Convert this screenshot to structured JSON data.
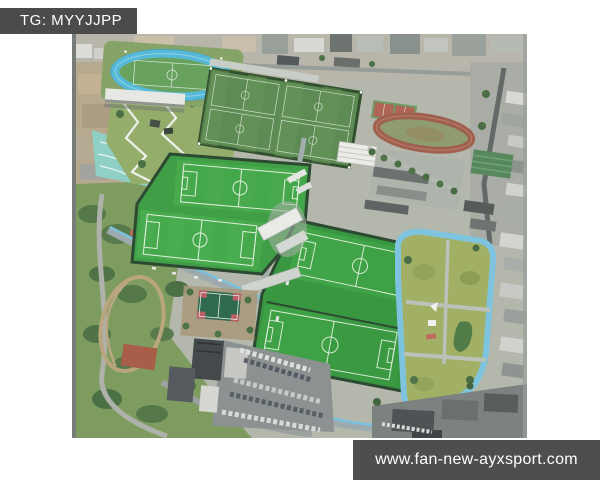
{
  "page": {
    "width": 600,
    "height": 480,
    "background": "#ffffff"
  },
  "watermarks": {
    "telegram": {
      "text": "TG: MYYJJPP",
      "background": "#4b4b4b",
      "color": "#ffffff"
    },
    "website": {
      "text": "www.fan-new-ayxsport.com",
      "background": "#4e4e4e",
      "color": "#ffffff"
    }
  },
  "photo": {
    "type": "aerial-drone-photograph",
    "alt": "Aerial view of a football training complex: a stadium with blue running track, natural grass training pitches, four artificial turf football fields, a school athletics track, a park ringed by a light-blue jogging loop, basketball court, parking lots, wooded hillside and surrounding city blocks",
    "regions": [
      "stadium-with-blue-track",
      "grandstand",
      "zigzag-park-paths",
      "teal-landscaped-slope",
      "natural-grass-training-field",
      "turf-pitch-a",
      "turf-pitch-b",
      "turf-pitch-c",
      "turf-pitch-d",
      "school-athletics-track",
      "tennis-courts",
      "clubhouse-buildings",
      "blue-jogging-loop-park",
      "basketball-court",
      "parking-lots",
      "wooded-hillside",
      "city-blocks"
    ],
    "colors": {
      "stadium_track_blue": "#56b9d8",
      "jogging_loop_blue": "#7fc4de",
      "turf_green": "#42a648",
      "deep_turf_green": "#3fa146",
      "natural_grass_green": "#5d8b53",
      "school_track_red": "#a0604f",
      "hillside_green": "#7e9c60",
      "park_lawn_olive": "#a2b065",
      "road_gray": "#9daaad",
      "building_white": "#e9ebe7"
    }
  }
}
